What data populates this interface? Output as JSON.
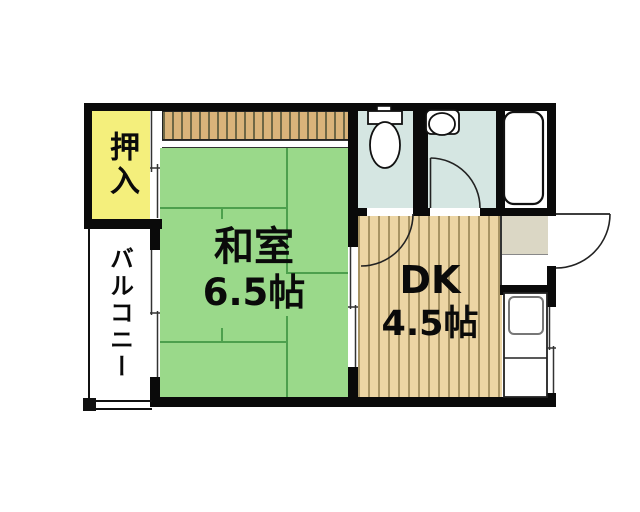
{
  "floorplan": {
    "rooms": {
      "washitsu": {
        "name": "和室",
        "size": "6.5帖"
      },
      "dk": {
        "name": "DK",
        "size": "4.5帖"
      },
      "oshiire": {
        "label": "押入"
      },
      "balcony": {
        "label": "バルコニー"
      }
    },
    "palette": {
      "tatami_green": "#9ad98a",
      "wood_tan": "#ecd5a4",
      "closet_yellow": "#f4ef7c",
      "wet_area_blue": "#d5e6e2",
      "entry_tile_gray": "#dbd7c5",
      "wall_black": "#0a0a0a"
    },
    "fixtures": [
      "toilet",
      "washbasin",
      "bathtub",
      "kitchen-sink",
      "entry-door",
      "room-doors",
      "sliding-doors",
      "windows"
    ]
  }
}
